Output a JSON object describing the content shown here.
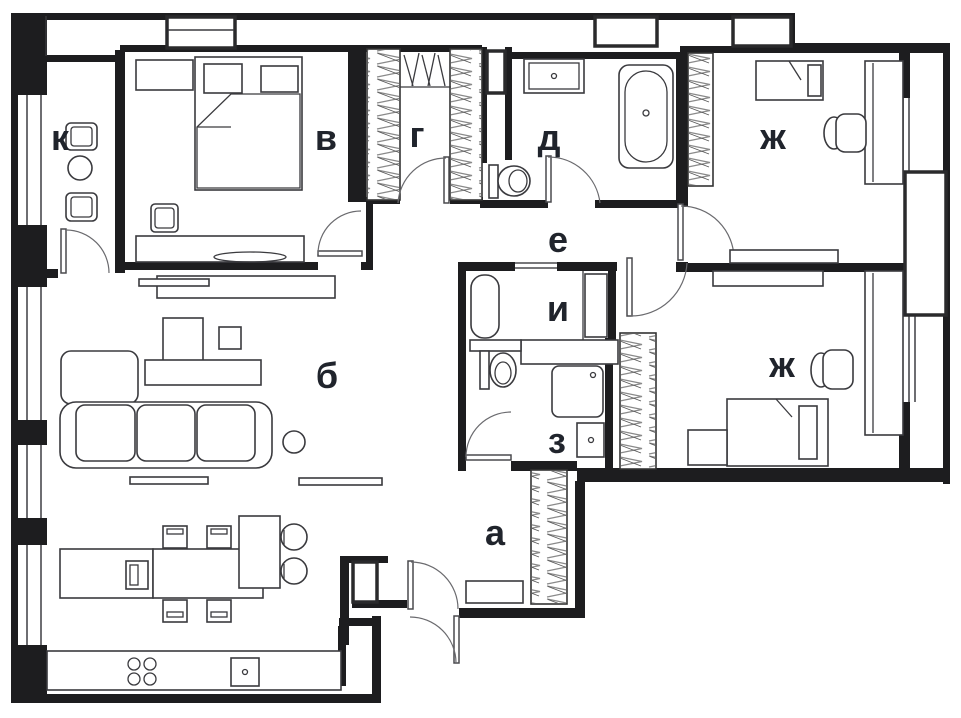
{
  "floor_plan": {
    "type": "apartment-floor-plan",
    "rooms": [
      {
        "id": "a",
        "label": "а"
      },
      {
        "id": "b",
        "label": "б"
      },
      {
        "id": "v",
        "label": "в"
      },
      {
        "id": "g",
        "label": "г"
      },
      {
        "id": "d",
        "label": "д"
      },
      {
        "id": "e",
        "label": "е"
      },
      {
        "id": "zh1",
        "label": "ж"
      },
      {
        "id": "z",
        "label": "з"
      },
      {
        "id": "i",
        "label": "и"
      },
      {
        "id": "k",
        "label": "к"
      },
      {
        "id": "zh2",
        "label": "ж"
      }
    ],
    "colors": {
      "wall": "#1d1d1f",
      "furniture_line": "#3a3a3e",
      "hatch": "#8a8a8a",
      "label": "#20242c",
      "background": "#ffffff"
    }
  }
}
